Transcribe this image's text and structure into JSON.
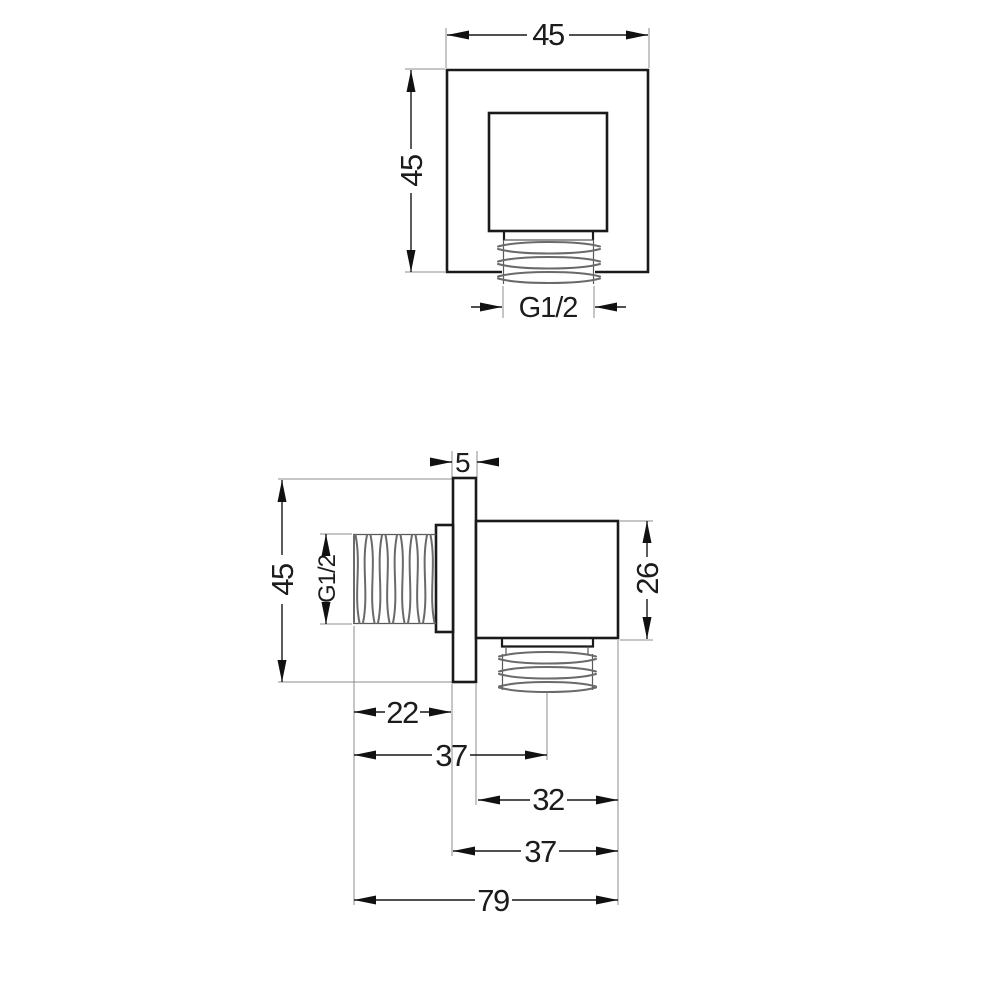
{
  "drawing": {
    "top_view": {
      "width": "45",
      "height": "45",
      "outlet_thread": "G1/2"
    },
    "side_view": {
      "plate_thickness": "5",
      "height": "45",
      "inlet_thread": "G1/2",
      "body_height": "26",
      "inlet_length": "22",
      "inlet_to_outlet_center": "37",
      "body_depth": "32",
      "plate_to_front": "37",
      "total_depth": "79"
    },
    "colors": {
      "background": "#ffffff",
      "line": "#1a1a1a",
      "thread": "#6a6a6a"
    }
  }
}
